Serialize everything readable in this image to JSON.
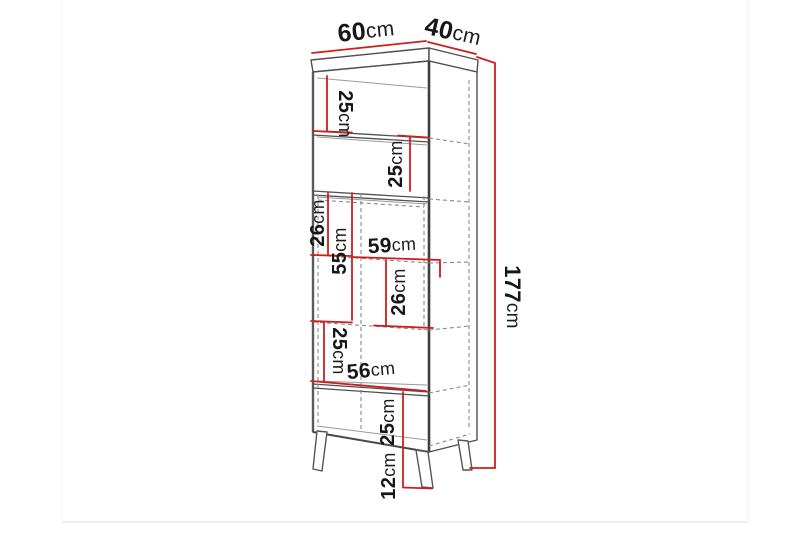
{
  "diagram": {
    "type": "furniture-dimension-diagram",
    "product": "tall display cabinet on splayed legs",
    "unit": "cm",
    "colors": {
      "dimension_line": "#cf1d1d",
      "text": "#161616",
      "outline": "#4f4f4f",
      "hidden_line": "#8a8a8a"
    },
    "dimensions": {
      "top_width": {
        "num": "60",
        "unit": "cm"
      },
      "top_depth": {
        "num": "40",
        "unit": "cm"
      },
      "height": {
        "num": "177",
        "unit": "cm"
      },
      "shelf_top": {
        "num": "25",
        "unit": "cm"
      },
      "shelf_second": {
        "num": "25",
        "unit": "cm"
      },
      "mid_upper": {
        "num": "26",
        "unit": "cm"
      },
      "mid_section": {
        "num": "55",
        "unit": "cm"
      },
      "inner_width": {
        "num": "59",
        "unit": "cm"
      },
      "mid_lower": {
        "num": "26",
        "unit": "cm"
      },
      "shelf_fifth": {
        "num": "25",
        "unit": "cm"
      },
      "lower_width": {
        "num": "56",
        "unit": "cm"
      },
      "shelf_bottom": {
        "num": "25",
        "unit": "cm"
      },
      "leg_height": {
        "num": "12",
        "unit": "cm"
      }
    }
  }
}
